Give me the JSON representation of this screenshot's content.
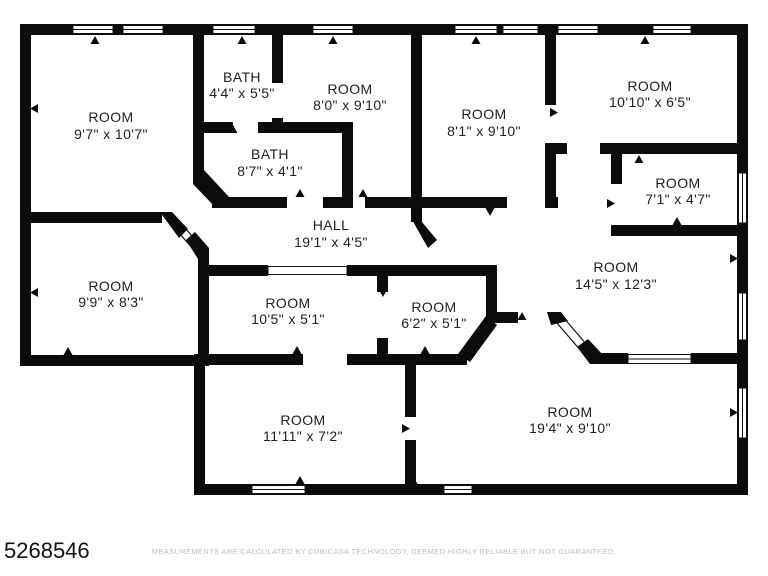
{
  "floorplan": {
    "rooms": [
      {
        "name": "ROOM",
        "dims": "9'7\" x 10'7\""
      },
      {
        "name": "BATH",
        "dims": "4'4\" x 5'5\""
      },
      {
        "name": "ROOM",
        "dims": "8'0\" x 9'10\""
      },
      {
        "name": "BATH",
        "dims": "8'7\" x 4'1\""
      },
      {
        "name": "HALL",
        "dims": "19'1\" x 4'5\""
      },
      {
        "name": "ROOM",
        "dims": "8'1\" x 9'10\""
      },
      {
        "name": "ROOM",
        "dims": "10'10\" x 6'5\""
      },
      {
        "name": "ROOM",
        "dims": "7'1\" x 4'7\""
      },
      {
        "name": "ROOM",
        "dims": "14'5\" x 12'3\""
      },
      {
        "name": "ROOM",
        "dims": "9'9\" x 8'3\""
      },
      {
        "name": "ROOM",
        "dims": "10'5\" x 5'1\""
      },
      {
        "name": "ROOM",
        "dims": "6'2\" x 5'1\""
      },
      {
        "name": "ROOM",
        "dims": "11'11\" x 7'2\""
      },
      {
        "name": "ROOM",
        "dims": "19'4\" x 9'10\""
      }
    ],
    "footer": {
      "plan_id": "5268546",
      "disclaimer": "MEASUREMENTS ARE CALCULATED BY CUBICASA TECHNOLOGY, DEEMED HIGHLY RELIABLE BUT NOT GUARANTEED."
    },
    "colors": {
      "wall": "#0b0b0b",
      "label": "#1f1f1f",
      "disclaimer": "#bdbdbd",
      "background": "#ffffff"
    }
  }
}
